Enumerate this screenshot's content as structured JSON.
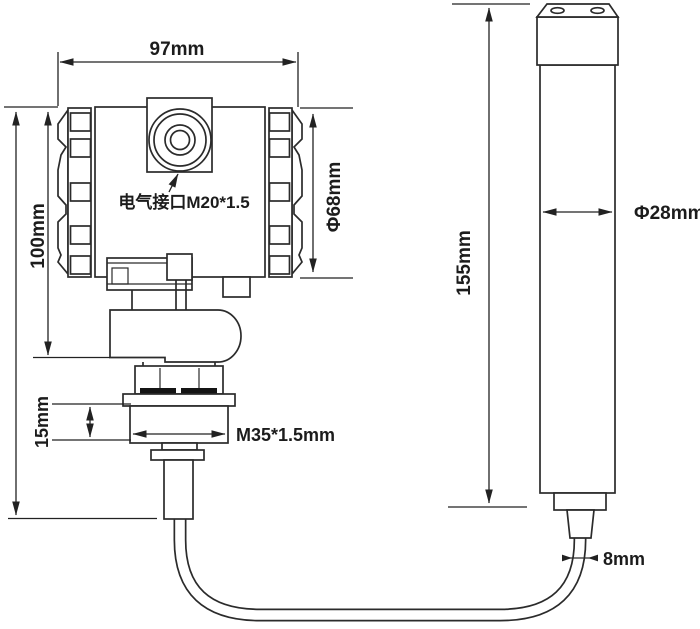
{
  "drawing": {
    "type": "dimension-drawing",
    "background": "#ffffff",
    "line_color": "#2b2b2b",
    "text_color": "#1c1c1c",
    "labels": {
      "housing_width": "97mm",
      "housing_height": "100mm",
      "housing_diameter": "Φ68mm",
      "electrical_port": "电气接口M20*1.5",
      "thread_spec": "M35*1.5mm",
      "thread_height": "15mm",
      "probe_length": "155mm",
      "probe_diameter": "Φ28mm",
      "cable_diameter": "8mm"
    }
  }
}
